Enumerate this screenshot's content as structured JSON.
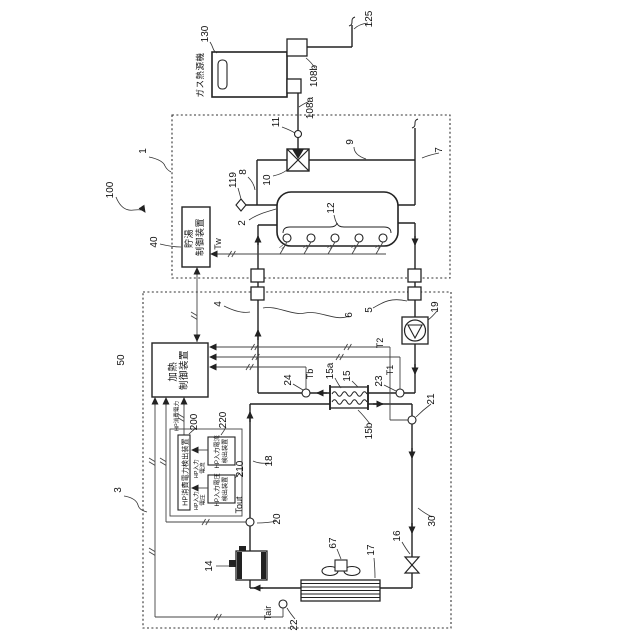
{
  "colors": {
    "line": "#222222",
    "signal": "#444444",
    "background": "#ffffff"
  },
  "system": {
    "ref": "100"
  },
  "gas_heater": {
    "ref": "130",
    "name": "ガス熱源機",
    "pipe_out": "125",
    "port_b": "108b",
    "port_a": "108a"
  },
  "storage_unit": {
    "ref": "1",
    "tank": "2",
    "tank_sensors": "12",
    "tw": "Tw",
    "controller_ref": "40",
    "controller_l1": "貯湯",
    "controller_l2": "制御装置",
    "valve": "10",
    "valve_sensor": "11",
    "drain": "119",
    "pipe7": "7",
    "pipe8": "8",
    "pipe9": "9"
  },
  "hp_unit": {
    "ref": "3",
    "controller_ref": "50",
    "controller_l1": "加熱",
    "controller_l2": "制御装置",
    "pipe4": "4",
    "pipe5": "5",
    "pipe6": "6",
    "pipe18": "18",
    "pipe30": "30",
    "pump": "19",
    "hx": "15",
    "hx_water": "15a",
    "hx_refrigerant": "15b",
    "s23": "23",
    "s24": "24",
    "s21": "21",
    "s20": "20",
    "s22": "22",
    "t1": "T1",
    "t2": "T2",
    "tb": "Tb",
    "tout": "Tout",
    "tair": "Tair",
    "compressor": "14",
    "expansion_valve": "16",
    "evaporator": "17",
    "fan": "67"
  },
  "power": {
    "main_ref": "200",
    "main_label": "HP消費電力検出装置",
    "current_ref": "220",
    "current_l1": "HP入力電流",
    "current_l2": "検出装置",
    "voltage_ref": "210",
    "voltage_l1": "HP入力電圧",
    "voltage_l2": "検出装置",
    "sig_current_l1": "HP入力",
    "sig_current_l2": "電流",
    "sig_voltage_l1": "HP入力",
    "sig_voltage_l2": "電圧",
    "sig_power": "HP消費電力"
  }
}
